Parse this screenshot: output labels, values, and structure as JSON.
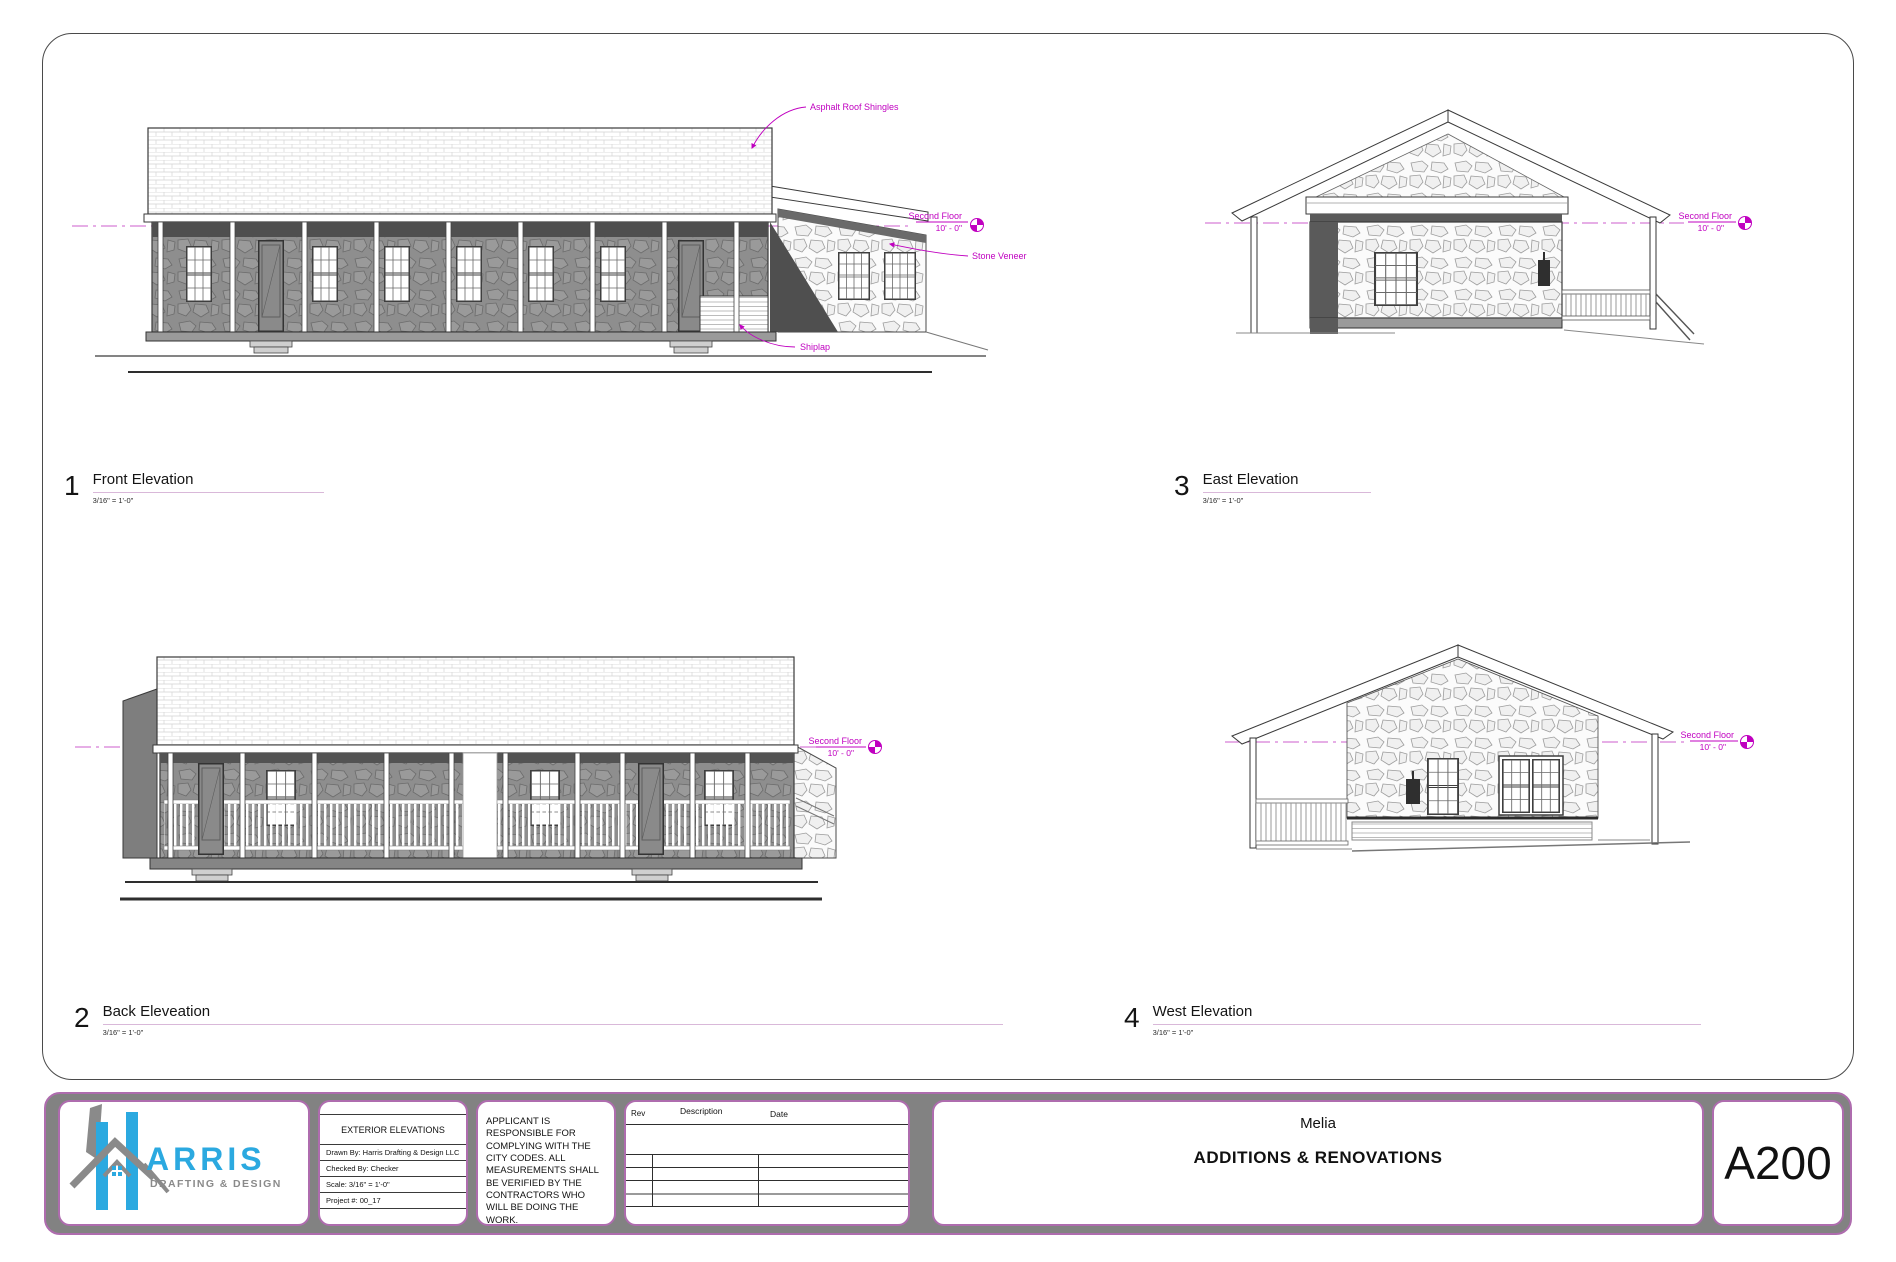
{
  "sheet": {
    "number_label": "A200",
    "project_name": "Melia",
    "project_subtitle": "ADDITIONS & RENOVATIONS"
  },
  "logo": {
    "wordmark": "ARRIS",
    "tagline": "DRAFTING & DESIGN"
  },
  "title_block": {
    "sheet_title": "EXTERIOR ELEVATIONS",
    "drawn_by": "Drawn By: Harris Drafting & Design LLC",
    "checked_by": "Checked By: Checker",
    "scale": "Scale:  3/16\" = 1'-0\"",
    "project_number": "Project #: 00_17",
    "disclaimer": "APPLICANT IS RESPONSIBLE FOR COMPLYING WITH THE CITY CODES. ALL MEASUREMENTS SHALL BE VERIFIED BY THE CONTRACTORS WHO WILL BE DOING THE WORK.",
    "revision_headers": [
      "Rev",
      "Description",
      "Date"
    ]
  },
  "views": [
    {
      "number": "1",
      "title": "Front Elevation",
      "scale": "3/16\" = 1'-0\""
    },
    {
      "number": "3",
      "title": "East Elevation",
      "scale": "3/16\" = 1'-0\""
    },
    {
      "number": "2",
      "title": "Back Eleveation",
      "scale": "3/16\" = 1'-0\""
    },
    {
      "number": "4",
      "title": "West Elevation",
      "scale": "3/16\" = 1'-0\""
    }
  ],
  "annotations": {
    "asphalt_roof": "Asphalt Roof Shingles",
    "stone_veneer": "Stone Veneer",
    "shiplap": "Shiplap",
    "level": {
      "label": "Second Floor",
      "value": "10' - 0\""
    }
  },
  "colors": {
    "annotation_magenta": "#C000C0",
    "level_line_magenta": "#CC5CCC",
    "title_block_border": "#AE6CAE",
    "title_block_gray": "#828282",
    "logo_blue": "#2BA9E0",
    "logo_gray": "#8A8A8A"
  }
}
